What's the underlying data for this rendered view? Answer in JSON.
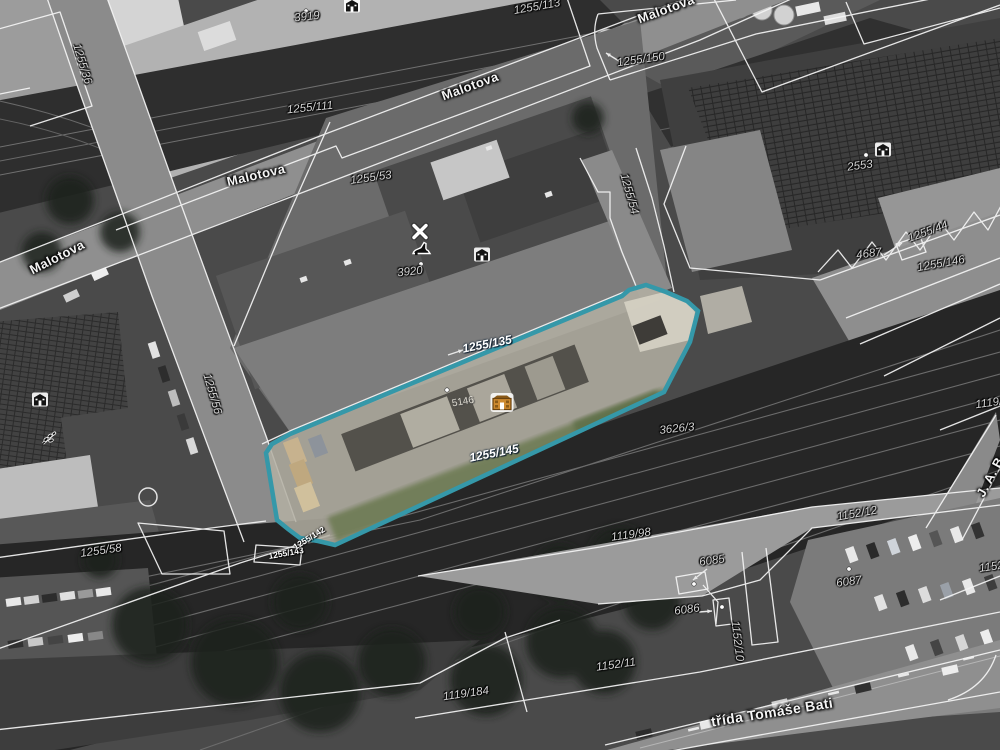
{
  "map": {
    "description": "Cadastral parcel map over grayscale aerial orthophoto with one parcel highlighted",
    "highlight": {
      "color": "#3598a9",
      "interior_tint": "#b3afa2",
      "parcel_number": "1255/145",
      "building_number": "5146"
    },
    "streets": [
      "Malotova",
      "třída Tomáše Bati",
      "J. A. B"
    ],
    "labels": [
      {
        "text": "3919",
        "x": 307,
        "y": 17,
        "rot": -6,
        "kind": "parcel"
      },
      {
        "text": "1255/113",
        "x": 537,
        "y": 7,
        "rot": -10,
        "kind": "parcel"
      },
      {
        "text": "1255/111",
        "x": 310,
        "y": 108,
        "rot": -6,
        "kind": "parcel"
      },
      {
        "text": "1255/150",
        "x": 641,
        "y": 60,
        "rot": -8,
        "kind": "parcel"
      },
      {
        "text": "1255/36",
        "x": 82,
        "y": 64,
        "rot": 73,
        "kind": "parcel"
      },
      {
        "text": "Malotova",
        "x": 470,
        "y": 86,
        "rot": -20,
        "kind": "street"
      },
      {
        "text": "Malotova",
        "x": 666,
        "y": 9,
        "rot": -20,
        "kind": "street"
      },
      {
        "text": "Malotova",
        "x": 256,
        "y": 175,
        "rot": -13,
        "kind": "street"
      },
      {
        "text": "Malotova",
        "x": 57,
        "y": 257,
        "rot": -27,
        "kind": "street"
      },
      {
        "text": "1255/53",
        "x": 371,
        "y": 178,
        "rot": -8,
        "kind": "parcel"
      },
      {
        "text": "1255/54",
        "x": 629,
        "y": 194,
        "rot": 74,
        "kind": "parcel"
      },
      {
        "text": "2553",
        "x": 860,
        "y": 166,
        "rot": -8,
        "kind": "parcel"
      },
      {
        "text": "4687",
        "x": 869,
        "y": 254,
        "rot": -8,
        "kind": "parcel"
      },
      {
        "text": "1255/44",
        "x": 928,
        "y": 232,
        "rot": -20,
        "kind": "parcel"
      },
      {
        "text": "1255/146",
        "x": 941,
        "y": 264,
        "rot": -10,
        "kind": "parcel"
      },
      {
        "text": "3920",
        "x": 410,
        "y": 272,
        "rot": -6,
        "kind": "parcel"
      },
      {
        "text": "1255/56",
        "x": 212,
        "y": 394,
        "rot": 74,
        "kind": "parcel"
      },
      {
        "text": "1255/135",
        "x": 487,
        "y": 344,
        "rot": -11,
        "kind": "white"
      },
      {
        "text": "3626/3",
        "x": 677,
        "y": 429,
        "rot": -6,
        "kind": "parcel"
      },
      {
        "text": "1255/145",
        "x": 494,
        "y": 453,
        "rot": -11,
        "kind": "white"
      },
      {
        "text": "5146",
        "x": 463,
        "y": 402,
        "rot": -10,
        "kind": "housenum"
      },
      {
        "text": "1119/9",
        "x": 992,
        "y": 403,
        "rot": -8,
        "kind": "parcel"
      },
      {
        "text": "J. A. B",
        "x": 990,
        "y": 477,
        "rot": -62,
        "kind": "street"
      },
      {
        "text": "1255/58",
        "x": 101,
        "y": 551,
        "rot": -8,
        "kind": "parcel"
      },
      {
        "text": "1255/143",
        "x": 286,
        "y": 553,
        "rot": -10,
        "kind": "tiny"
      },
      {
        "text": "1255/142",
        "x": 309,
        "y": 538,
        "rot": -32,
        "kind": "tiny"
      },
      {
        "text": "1119/98",
        "x": 631,
        "y": 535,
        "rot": -8,
        "kind": "parcel"
      },
      {
        "text": "6085",
        "x": 712,
        "y": 561,
        "rot": -8,
        "kind": "parcel"
      },
      {
        "text": "6086",
        "x": 687,
        "y": 610,
        "rot": -8,
        "kind": "parcel"
      },
      {
        "text": "6087",
        "x": 849,
        "y": 582,
        "rot": -8,
        "kind": "parcel"
      },
      {
        "text": "1152/12",
        "x": 857,
        "y": 514,
        "rot": -10,
        "kind": "parcel"
      },
      {
        "text": "1152/10",
        "x": 737,
        "y": 641,
        "rot": 83,
        "kind": "parcel"
      },
      {
        "text": "1152/11",
        "x": 616,
        "y": 665,
        "rot": -8,
        "kind": "parcel"
      },
      {
        "text": "1152/",
        "x": 993,
        "y": 567,
        "rot": -8,
        "kind": "parcel"
      },
      {
        "text": "1119/184",
        "x": 466,
        "y": 694,
        "rot": -8,
        "kind": "parcel"
      },
      {
        "text": "třída Tomáše Bati",
        "x": 772,
        "y": 712,
        "rot": -9,
        "kind": "street-big"
      }
    ],
    "icons": [
      {
        "name": "building-icon",
        "x": 352,
        "y": 8
      },
      {
        "name": "building-icon",
        "x": 883,
        "y": 152
      },
      {
        "name": "building-icon",
        "x": 482,
        "y": 257
      },
      {
        "name": "building-icon",
        "x": 40,
        "y": 402
      },
      {
        "name": "leaf-icon",
        "x": 49,
        "y": 441
      },
      {
        "name": "x-icon",
        "x": 420,
        "y": 234
      },
      {
        "name": "shoe-icon",
        "x": 422,
        "y": 251
      },
      {
        "name": "poi-building-icon",
        "x": 502,
        "y": 405
      }
    ],
    "dots": [
      [
        306,
        11
      ],
      [
        421,
        264
      ],
      [
        447,
        390
      ],
      [
        866,
        155
      ],
      [
        849,
        569
      ],
      [
        694,
        584
      ],
      [
        722,
        607
      ]
    ],
    "arrows": [
      {
        "from": [
          627,
          66
        ],
        "to": [
          606,
          53
        ]
      },
      {
        "from": [
          884,
          255
        ],
        "to": [
          902,
          243
        ]
      },
      {
        "from": [
          448,
          355
        ],
        "to": [
          463,
          350
        ]
      },
      {
        "from": [
          707,
          569
        ],
        "to": [
          693,
          580
        ]
      },
      {
        "from": [
          699,
          612
        ],
        "to": [
          712,
          611
        ]
      }
    ]
  }
}
